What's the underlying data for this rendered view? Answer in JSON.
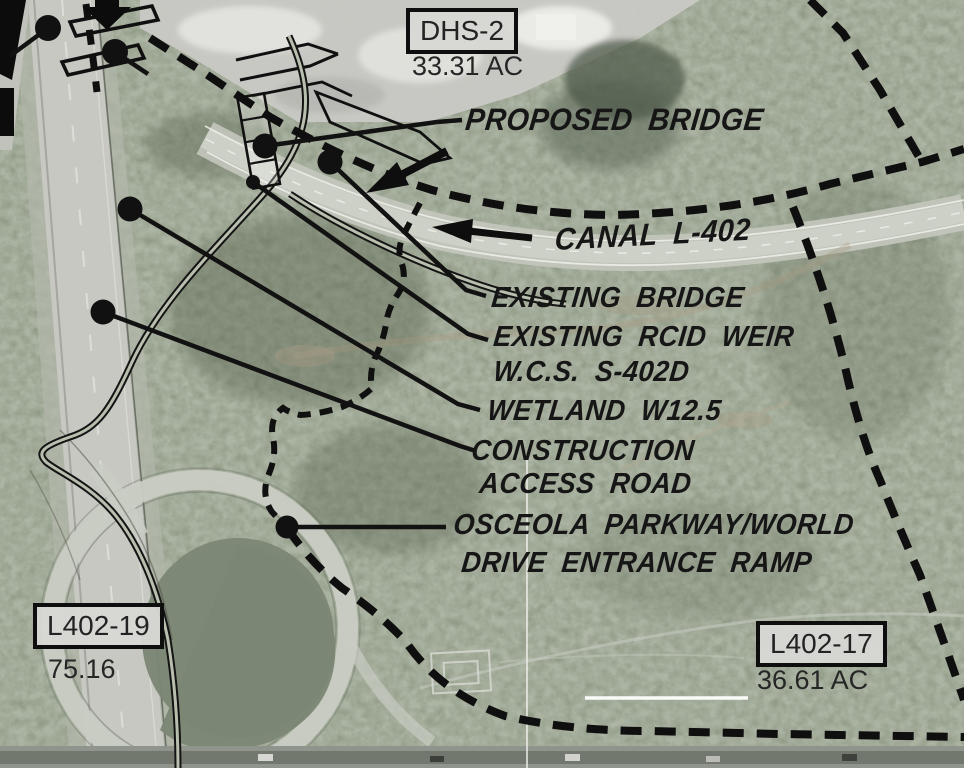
{
  "title": "Site plan aerial exhibit — Canal L-402 / Osceola Parkway area",
  "labels": {
    "proposed_bridge": "PROPOSED BRIDGE",
    "canal": "CANAL L-402",
    "existing_bridge": "EXISTING BRIDGE",
    "rcid_weir_line1": "EXISTING RCID WEIR",
    "rcid_weir_line2": "W.C.S. S-402D",
    "wetland": "WETLAND W12.5",
    "construction_line1": "CONSTRUCTION",
    "construction_line2": "ACCESS ROAD",
    "osceola_line1": "OSCEOLA PARKWAY/WORLD",
    "osceola_line2": "DRIVE ENTRANCE RAMP"
  },
  "parcels": [
    {
      "id": "DHS-2",
      "area": "33.31 AC"
    },
    {
      "id": "L402-19",
      "area": "75.16"
    },
    {
      "id": "L402-17",
      "area": "36.61 AC"
    }
  ],
  "colors": {
    "linework": "#111111",
    "terrain_base": "#98a08d",
    "road_gray": "#c7c8c2",
    "pond": "#7b8674",
    "parcel_box_fill": "#d7d7d4"
  }
}
